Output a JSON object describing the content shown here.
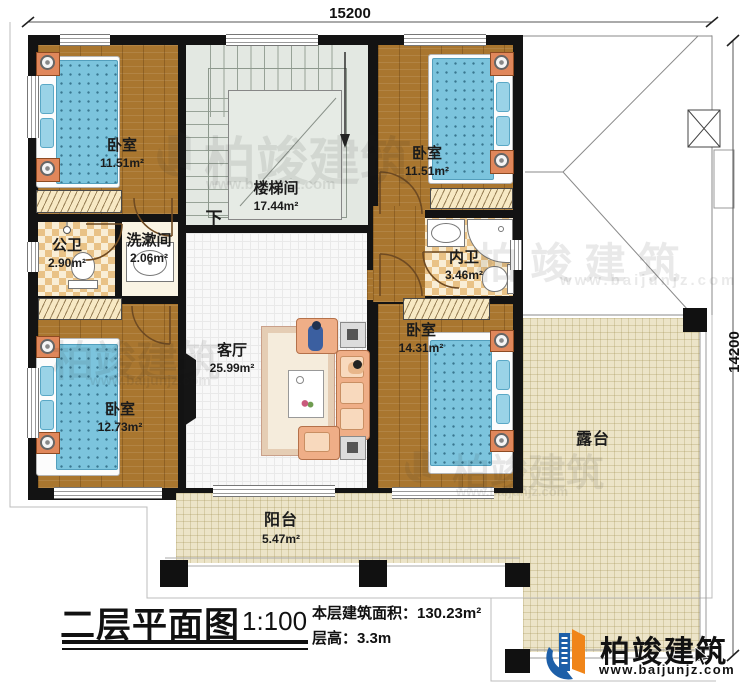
{
  "dims": {
    "top": "15200",
    "right": "14200"
  },
  "rooms": {
    "bedroom_tl": {
      "name": "卧室",
      "area": "11.51m²"
    },
    "stairwell": {
      "name": "楼梯间",
      "area": "17.44m²",
      "down": "下"
    },
    "bedroom_tr": {
      "name": "卧室",
      "area": "11.51m²"
    },
    "public_bath": {
      "name": "公卫",
      "area": "2.90m²"
    },
    "washroom": {
      "name": "洗漱间",
      "area": "2.06m²"
    },
    "ensuite": {
      "name": "内卫",
      "area": "3.46m²"
    },
    "bedroom_bl": {
      "name": "卧室",
      "area": "12.73m²"
    },
    "living": {
      "name": "客厅",
      "area": "25.99m²"
    },
    "bedroom_br": {
      "name": "卧室",
      "area": "14.31m²"
    },
    "terrace": {
      "name": "露台"
    },
    "balcony": {
      "name": "阳台",
      "area": "5.47m²"
    }
  },
  "titleblock": {
    "title": "二层平面图",
    "scale": "1:100",
    "area_line": "本层建筑面积：130.23m²",
    "height_line": "层高：3.3m"
  },
  "brand": {
    "name": "柏竣建筑",
    "site": "www.baijunjz.com"
  },
  "watermark": {
    "name": "柏竣建筑",
    "site": "www.baijunjz.com"
  },
  "colors": {
    "accent_blue": "#1d5fa8",
    "accent_orange": "#f08519",
    "wall": "#131313"
  }
}
